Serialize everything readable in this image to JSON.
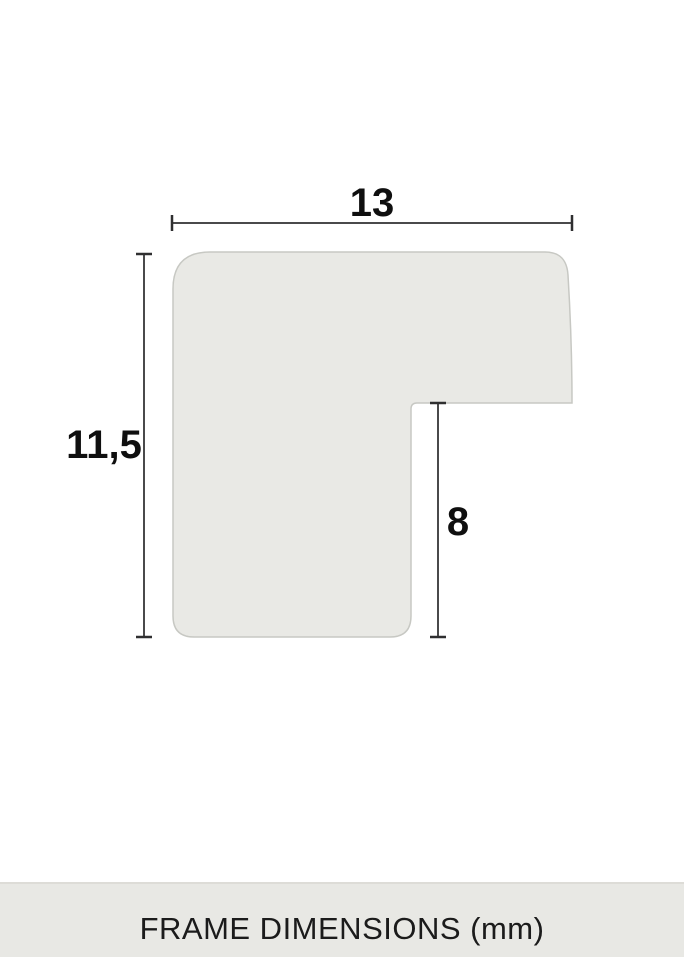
{
  "diagram": {
    "title_semantic": "frame-profile-cross-section",
    "labels": {
      "width": "13",
      "height": "11,5",
      "rabbet_depth": "8"
    },
    "colors": {
      "shape_fill": "#e9e9e5",
      "shape_stroke": "#c7c8c3",
      "dimension_line": "#4a4a4b",
      "dimension_tick": "#2f2f30",
      "label_text": "#0f0f0f"
    }
  },
  "footer": {
    "title": "FRAME DIMENSIONS (mm)",
    "background": "#e8e8e4",
    "text_color": "#1b1b1b"
  }
}
